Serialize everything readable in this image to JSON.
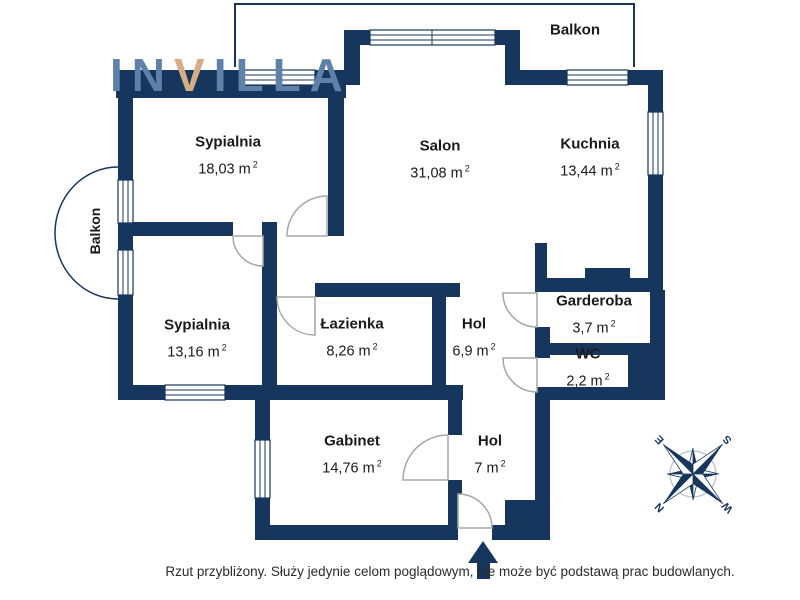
{
  "logo": {
    "part1": "IN",
    "v": "V",
    "part2": "ILLA"
  },
  "balconies": {
    "top": "Balkon",
    "left": "Balkon"
  },
  "rooms": [
    {
      "name": "Sypialnia",
      "area": "18,03 m",
      "sup": "2"
    },
    {
      "name": "Salon",
      "area": "31,08 m",
      "sup": "2"
    },
    {
      "name": "Kuchnia",
      "area": "13,44 m",
      "sup": "2"
    },
    {
      "name": "Sypialnia",
      "area": "13,16 m",
      "sup": "2"
    },
    {
      "name": "Łazienka",
      "area": "8,26 m",
      "sup": "2"
    },
    {
      "name": "Hol",
      "area": "6,9 m",
      "sup": "2"
    },
    {
      "name": "Garderoba",
      "area": "3,7 m",
      "sup": "2"
    },
    {
      "name": "WC",
      "area": "2,2 m",
      "sup": "2"
    },
    {
      "name": "Gabinet",
      "area": "14,76 m",
      "sup": "2"
    },
    {
      "name": "Hol",
      "area": "7 m",
      "sup": "2"
    }
  ],
  "compass": {
    "n": "N",
    "e": "E",
    "s": "S",
    "w": "W"
  },
  "footer": {
    "disclaimer": "Rzut przybliżony. Służy jedynie celom poglądowym, nie może być podstawą prac budowlanych."
  },
  "colors": {
    "wall": "#17365d",
    "logo_blue": "#5e81a8",
    "logo_tan": "#d5ad87",
    "door_arc": "#a7a7a7",
    "compass_ring": "#c2ccd6",
    "text": "#1a1a1a"
  }
}
